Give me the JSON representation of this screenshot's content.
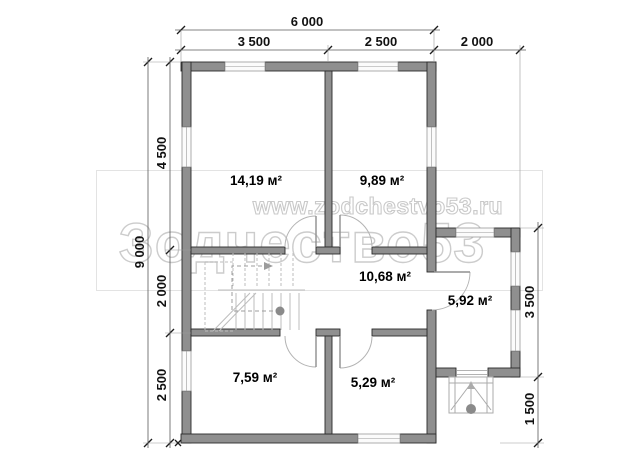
{
  "watermark": {
    "url": "www.zodchestvo53.ru",
    "brand": "Зодчество53"
  },
  "dims": {
    "top": {
      "total": "6 000",
      "left": "3 500",
      "right": "2 500",
      "ext": "2 000"
    },
    "left": {
      "total": "9 000",
      "top": "4 500",
      "middle": "2 000",
      "bottom": "2 500"
    },
    "right": {
      "ext": "3 500",
      "porch": "1 500"
    }
  },
  "rooms": [
    {
      "name": "room-top-left",
      "area": "14,19 м²"
    },
    {
      "name": "room-top-right",
      "area": "9,89 м²"
    },
    {
      "name": "hall-stairs",
      "area": "10,68 м²"
    },
    {
      "name": "extension",
      "area": "5,92 м²"
    },
    {
      "name": "room-bottom-left",
      "area": "7,59 м²"
    },
    {
      "name": "room-bottom-right",
      "area": "5,29 м²"
    }
  ],
  "colors": {
    "wall": "#8f8f8f",
    "wall_outline": "#2b2b2b",
    "window": "#fbfbfb",
    "dimension_text": "#111111",
    "watermark": "#c9c9c9",
    "stairs": "#bdbdbd"
  }
}
